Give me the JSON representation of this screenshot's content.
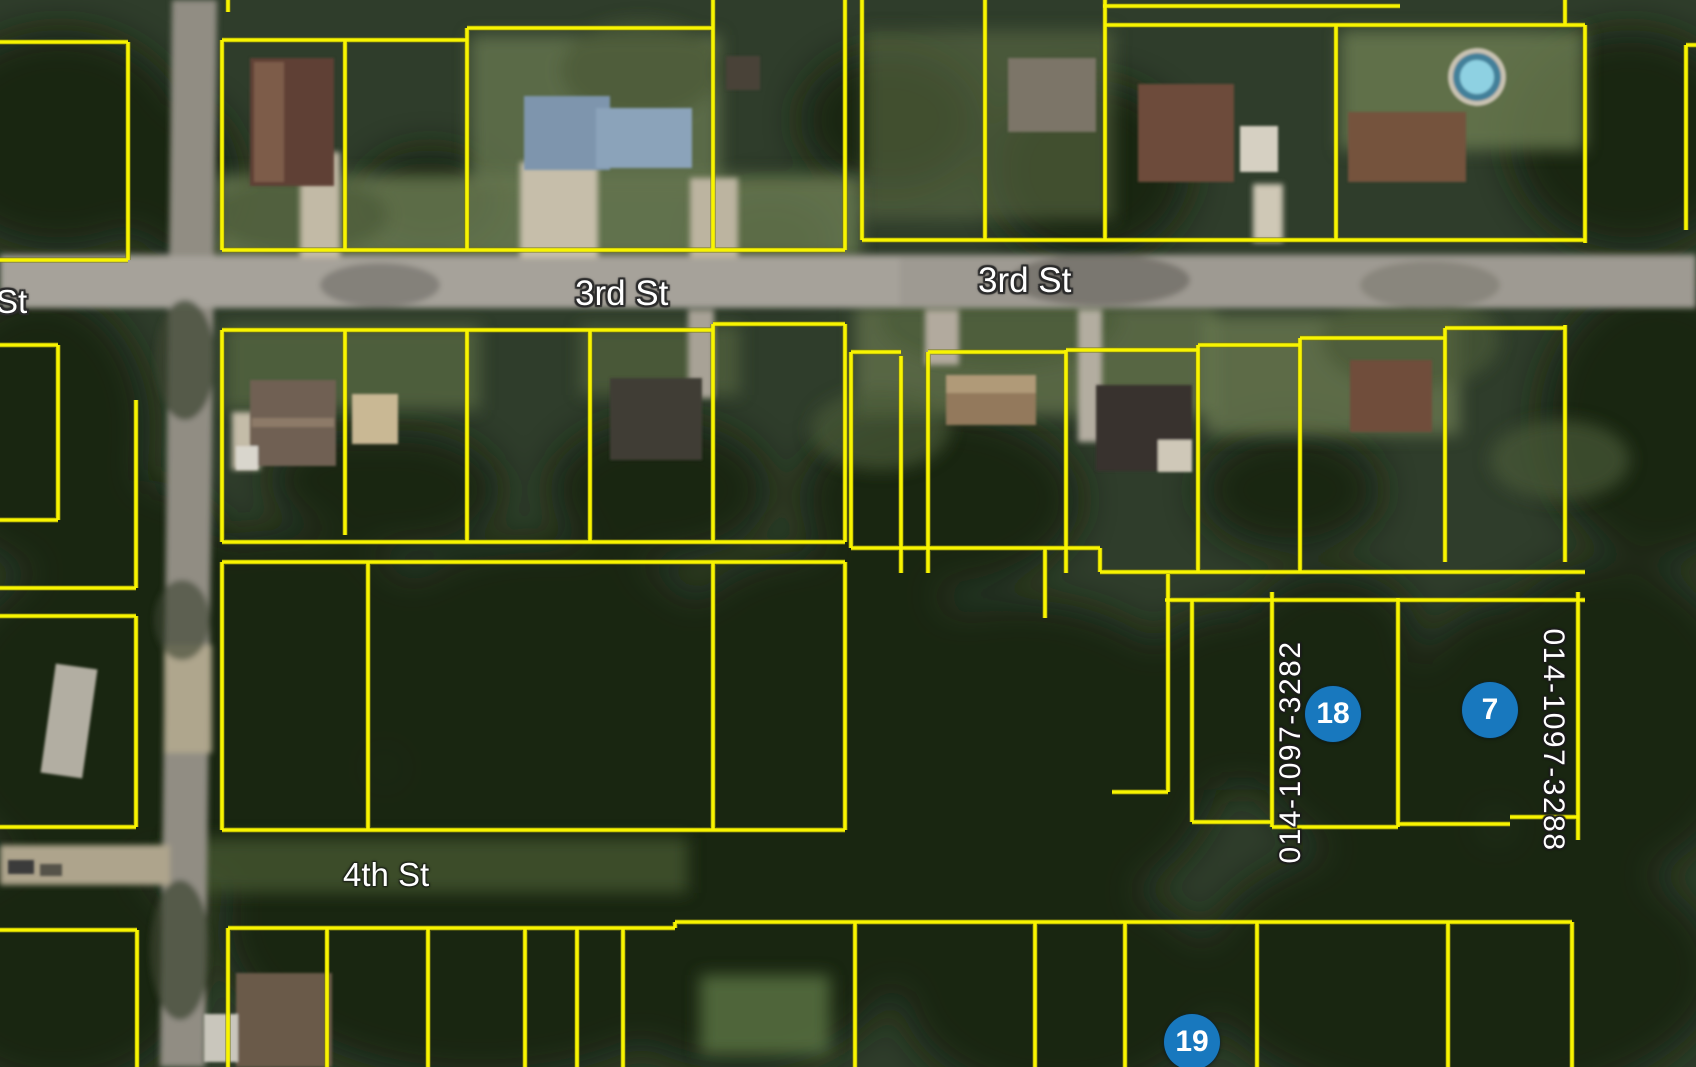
{
  "map": {
    "street_labels": [
      {
        "text": "3rd St"
      },
      {
        "text": "3rd St"
      },
      {
        "text": "4th St"
      },
      {
        "text": "St"
      }
    ],
    "parcel_id_labels": [
      {
        "text": "014-1097-3282"
      },
      {
        "text": "014-1097-3288"
      }
    ],
    "markers": [
      {
        "label": "18"
      },
      {
        "label": "7"
      },
      {
        "label": "19"
      }
    ],
    "colors": {
      "parcel_line": "#f8f400",
      "marker_fill": "#1878be",
      "marker_text": "#ffffff",
      "label_text": "#ffffff"
    }
  }
}
